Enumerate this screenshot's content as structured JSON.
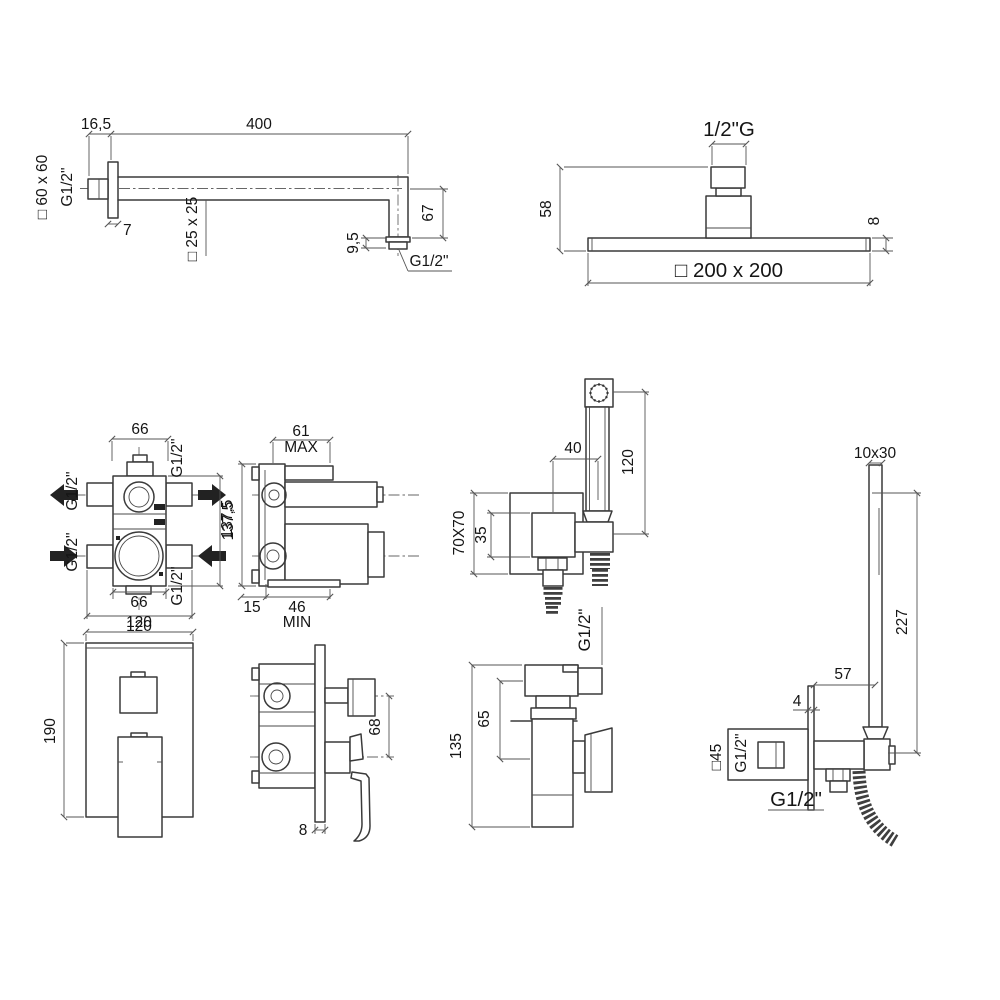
{
  "colors": {
    "line": "#3a3a3a",
    "dimension": "#555555",
    "text": "#151515",
    "background": "#ffffff"
  },
  "arm": {
    "offset": "16,5",
    "length": "400",
    "flange_size": "□ 60 x 60",
    "wall_thread": "G1/2\"",
    "flange_thk": "7",
    "tube_size": "□ 25 x 25",
    "drop": "67",
    "tip_h": "9,5",
    "end_thread": "G1/2\""
  },
  "head": {
    "thread": "1/2\"G",
    "height": "58",
    "thk": "8",
    "size": "□ 200 x 200"
  },
  "valve_front": {
    "w_top": "66",
    "g_tl": "G1/2\"",
    "g_tr": "G1/2\"",
    "g_bl": "G1/2\"",
    "g_br": "G1/2\"",
    "height": "137,5",
    "w_bot": "66",
    "w_total": "120"
  },
  "valve_side": {
    "depth": "61",
    "depth_note": "MAX",
    "height": "137,5",
    "d15": "15",
    "d46": "46",
    "min_note": "MIN"
  },
  "handset": {
    "offset": "40",
    "length": "120",
    "plate": "70X70",
    "inner": "35"
  },
  "outlet_mid": {
    "thread": "G1/2\"",
    "axis": "65",
    "height": "135"
  },
  "plate": {
    "width": "120",
    "height": "190"
  },
  "mixer_side": {
    "spacing": "68",
    "thk": "8"
  },
  "handset_right": {
    "section": "10x30",
    "length": "227",
    "reach": "57",
    "plate_thk": "4",
    "plate": "□45",
    "wall_thread": "G1/2\"",
    "outlet_thread": "G1/2\""
  }
}
